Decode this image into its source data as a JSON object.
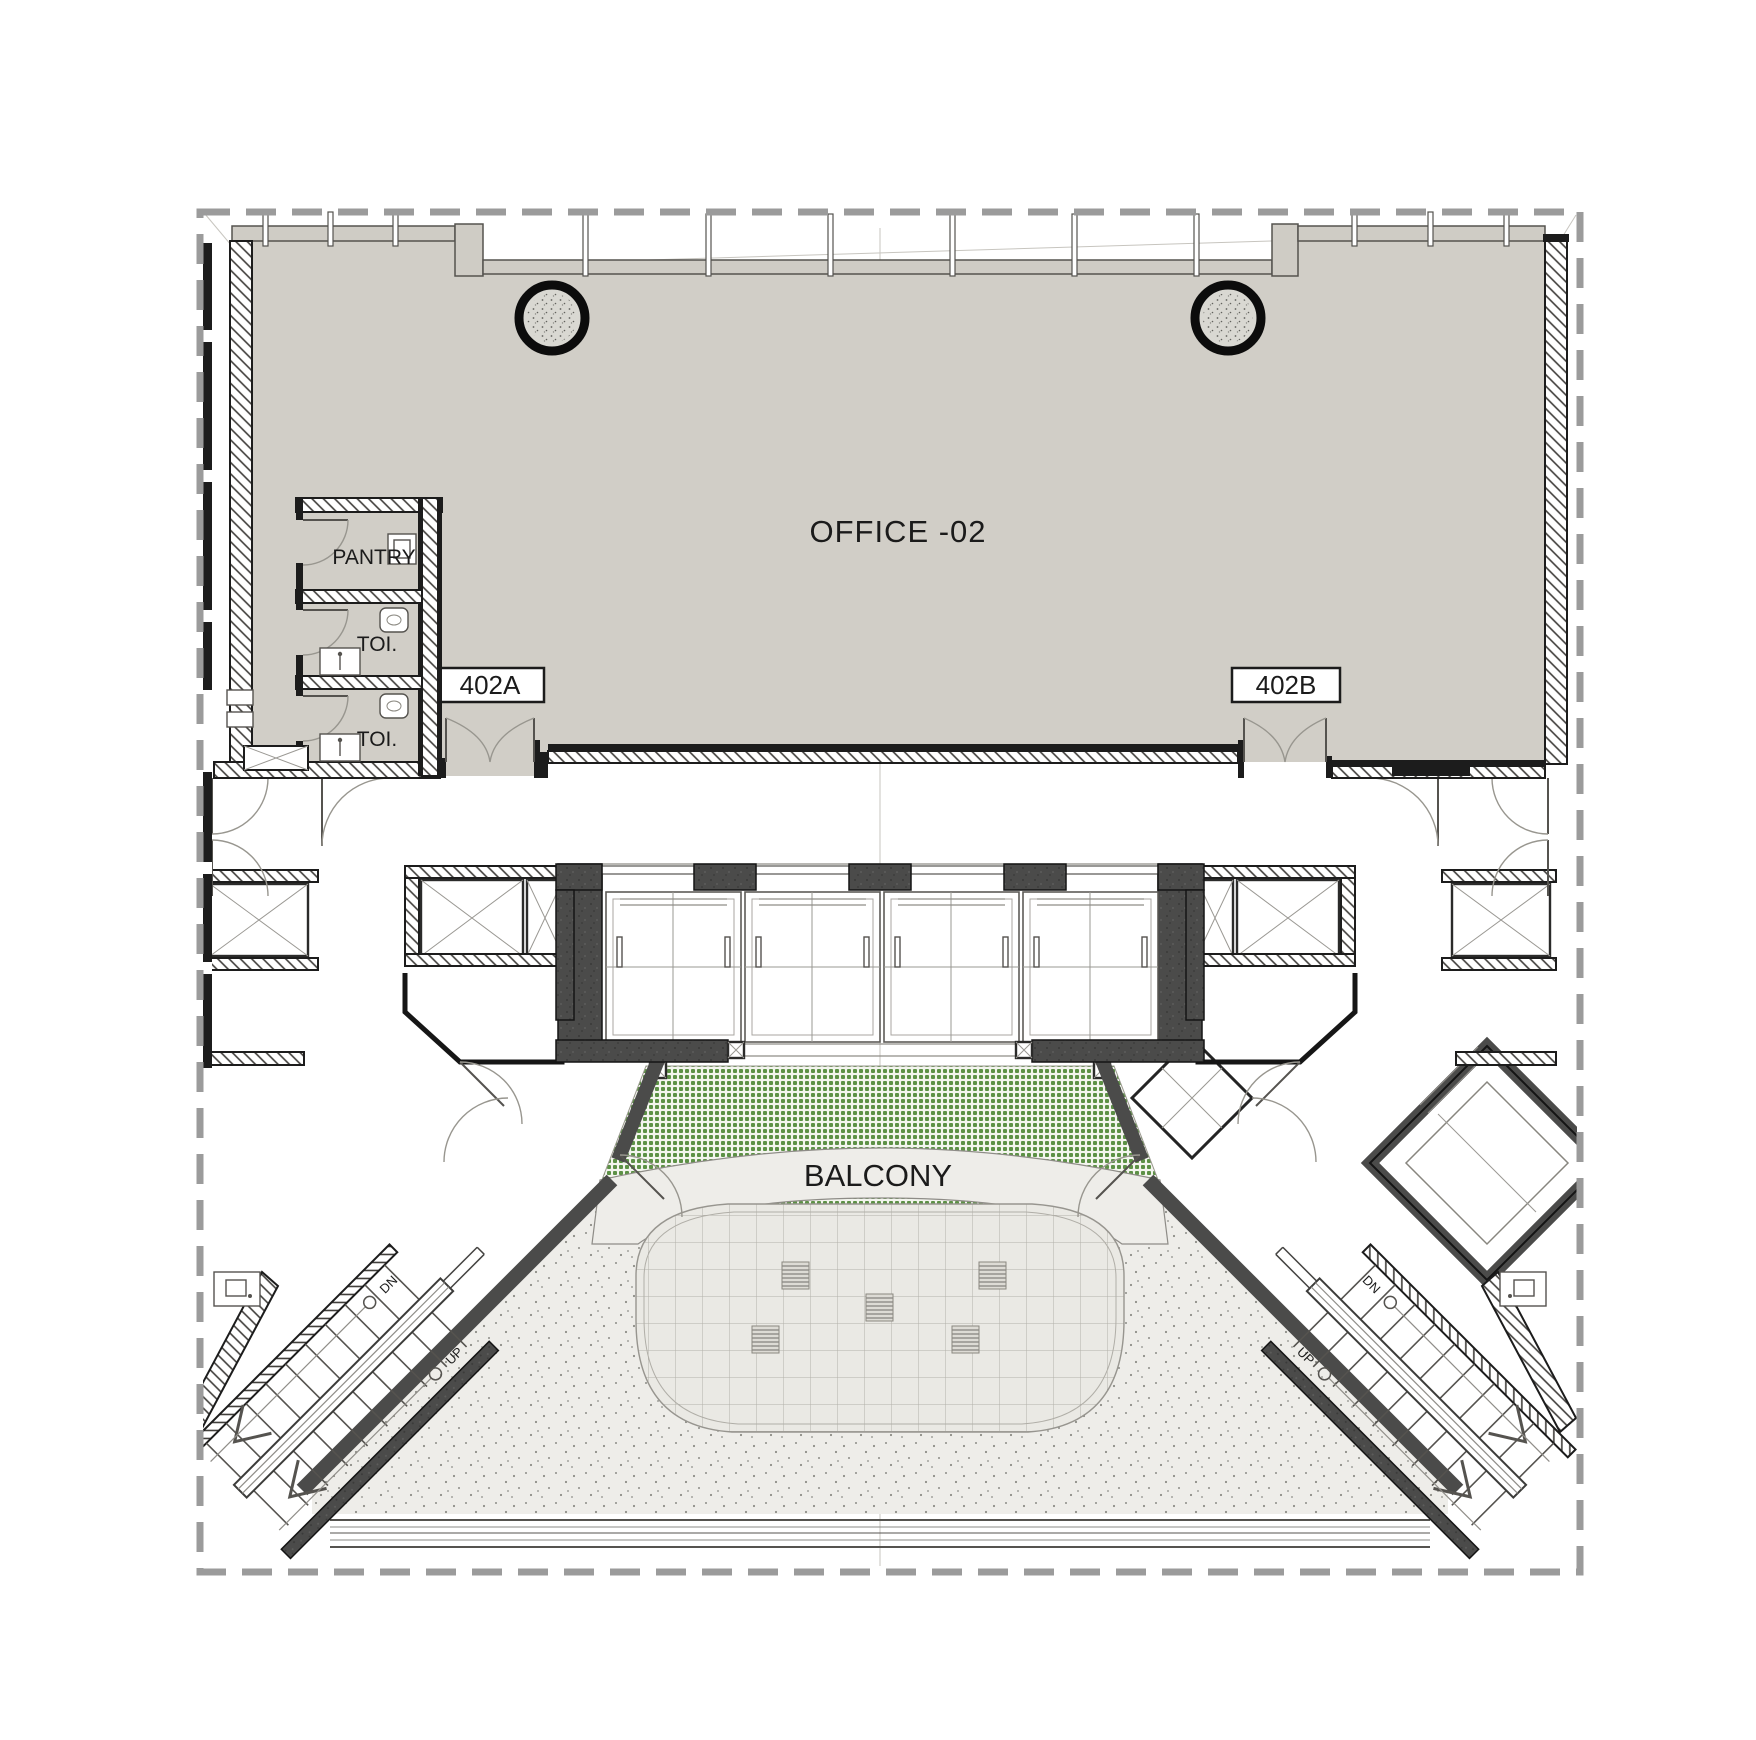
{
  "plan": {
    "type": "architectural-floor-plan",
    "rooms": {
      "office": {
        "label": "OFFICE -02"
      },
      "pantry": {
        "label": "PANTRY"
      },
      "toilet_upper": {
        "label": "TOI."
      },
      "toilet_lower": {
        "label": "TOI."
      },
      "balcony": {
        "label": "BALCONY"
      }
    },
    "door_tags": {
      "a": {
        "label": "402A"
      },
      "b": {
        "label": "402B"
      }
    },
    "stair_left": {
      "down": "DN",
      "up": "UP"
    },
    "stair_right": {
      "down": "DN",
      "up": "UP"
    },
    "colors": {
      "room_fill": "#d1cec7",
      "core_wall": "#4b4b4a",
      "wall_line": "#1c1c1c",
      "boundary": "#9b9b9b",
      "planting": "#5d9146",
      "paving": "#eeede9",
      "stipple_dot": "#8d8d87",
      "tile_line": "#b3b1aa"
    }
  }
}
